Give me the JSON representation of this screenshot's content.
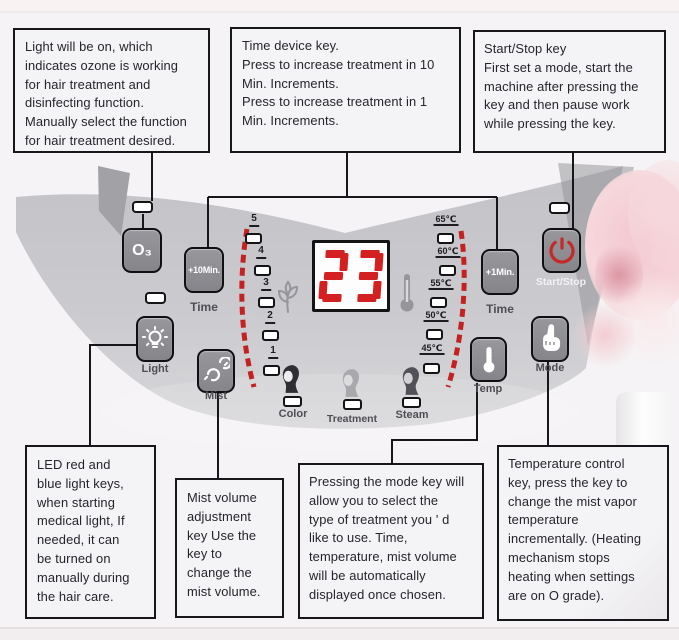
{
  "callouts": {
    "light_key": "Light will be on, which\nindicates ozone is working\nfor hair treatment and\ndisinfecting function.\nManually select the function\nfor hair treatment desired.",
    "time_key": "Time device key.\nPress to increase treatment in 10\nMin. Increments.\nPress to increase treatment in 1\nMin. Increments.",
    "start_stop_key": "Start/Stop key\nFirst set a mode, start the\nmachine after pressing the\nkey and then pause work\nwhile pressing the key.",
    "led_key": "LED red and\nblue light keys,\nwhen starting\nmedical light, If\nneeded, it can\nbe turned on\nmanually during\nthe hair care.",
    "mist_key": "Mist volume\nadjustment\nkey Use the\nkey to\nchange the\nmist volume.",
    "mode_key": "Pressing the mode key will\nallow you to select the\ntype of treatment you ' d\nlike to use. Time,\ntemperature, mist volume\nwill be automatically\ndisplayed once chosen.",
    "temp_key": "Temperature control\nkey, press the key to\nchange the mist vapor\ntemperature\nincrementally. (Heating\nmechanism stops\nheating when settings\nare on O grade)."
  },
  "panel": {
    "display": {
      "value": "23"
    },
    "buttons": {
      "o3": "O₃",
      "plus10min": "+10Min.",
      "plus1min": "+1Min.",
      "time_left_label": "Time",
      "time_right_label": "Time",
      "start_stop_label": "Start/Stop",
      "light_label": "Light",
      "mist_label": "Mist",
      "temp_label": "Temp",
      "mode_label": "Mode"
    },
    "mode_indicators": {
      "color": "Color",
      "treatment": "Treatment",
      "steam": "Steam"
    },
    "mist_levels": [
      "5",
      "4",
      "3",
      "2",
      "1"
    ],
    "temperatures": [
      "65℃",
      "60℃",
      "55℃",
      "50℃",
      "45℃"
    ],
    "icons": {
      "light_button": "light-bulb-icon",
      "mist_button": "mist-spray-icon",
      "start_stop_button": "power-icon",
      "temp_button": "thermometer-icon",
      "mode_button": "press-finger-icon",
      "left_of_display": "steam-plant-icon",
      "right_of_display": "thermometer-icon"
    }
  },
  "colors": {
    "led_red": "#d32121",
    "dash_red": "#c22222",
    "panel_gray": "#c9c9cd",
    "button_gray": "#8b8b90",
    "line_black": "#17171b",
    "flower_pink": "#f4ccd2"
  }
}
